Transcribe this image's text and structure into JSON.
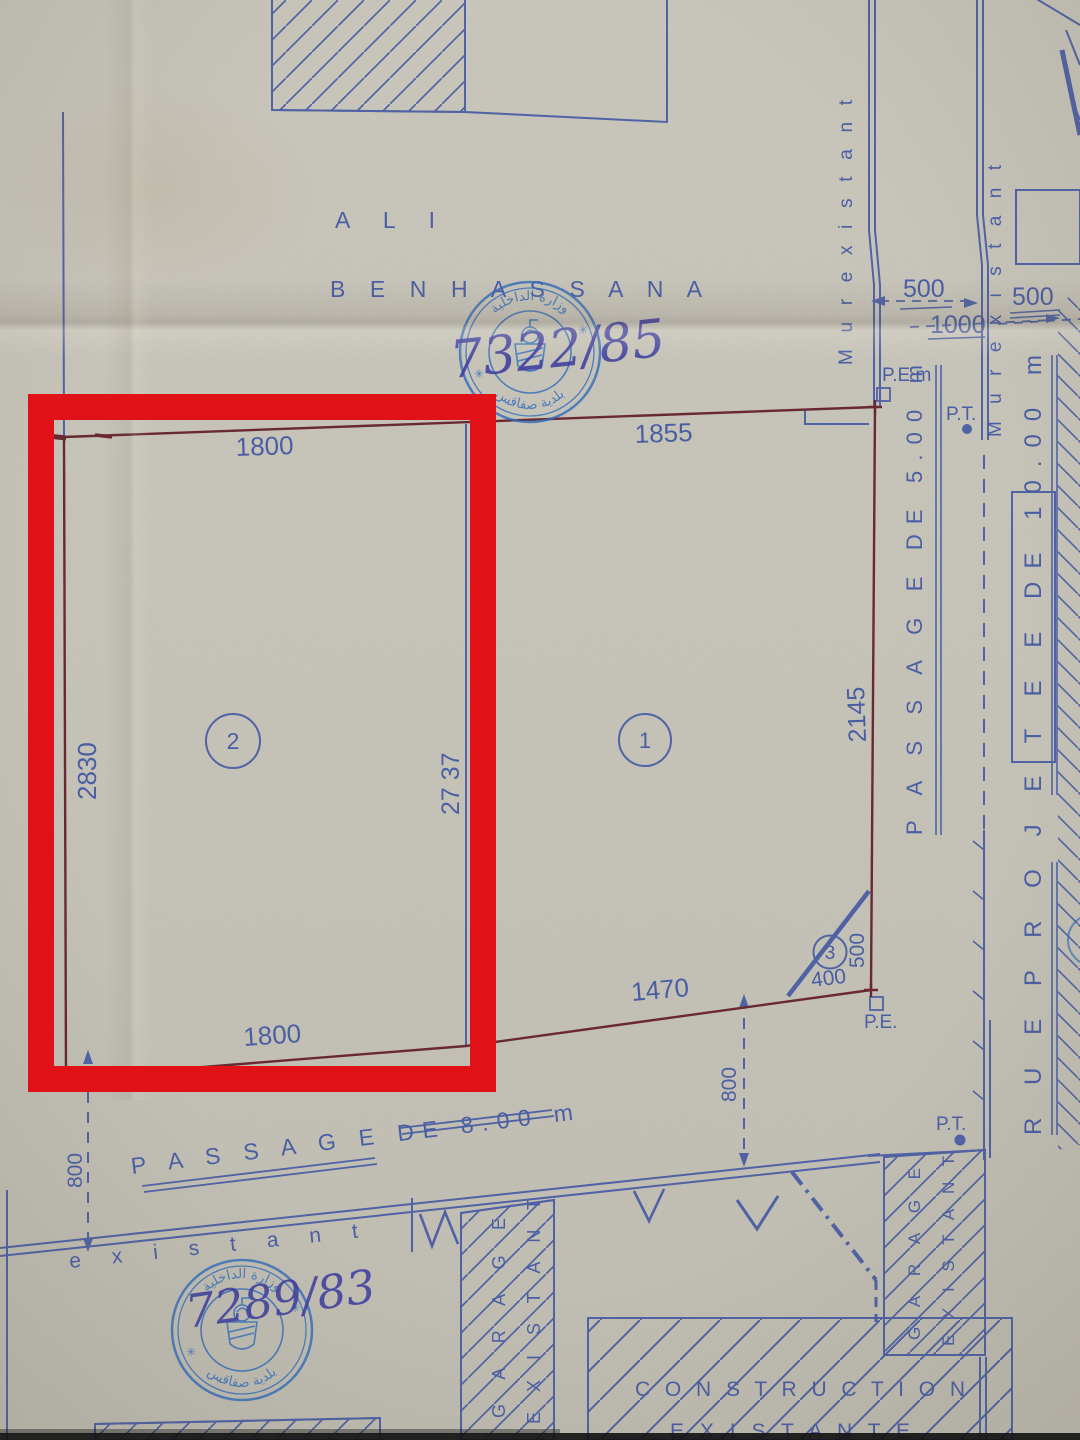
{
  "owner": {
    "line1": "A L I",
    "line2": "B E N   H A S S A N A"
  },
  "stamps": {
    "ministry_arabic": "وزارة الداخلية",
    "municipality_arabic": "بلدية صفاقس",
    "top_ref": "7322/85",
    "bottom_ref": "7289/83"
  },
  "parcels": {
    "p2": {
      "number": "2",
      "top": "1800",
      "bottom": "1800",
      "left": "2830",
      "divider": "27 37"
    },
    "p1": {
      "number": "1",
      "top": "1855",
      "bottom": "1470",
      "right": "2145"
    },
    "p3": {
      "number": "3",
      "bottom": "400",
      "side": "500"
    }
  },
  "dims": {
    "d500_a": "500",
    "d1000": "1000",
    "d500_b": "500",
    "d800_left": "800",
    "d800_right": "800"
  },
  "labels": {
    "mur_existant": "M u r   e x i s t a n t",
    "passage_east": "P A S S A G E   DE   5.00 m",
    "passage_south": "P A S S A G E    DE   8.00 m",
    "rue": "R U E   P R O J E T E E   DE   10.00 m",
    "existant": "e x i s t a n t",
    "garage_line1": "G A R A G E",
    "garage_line2": "E X I S T A N T",
    "construction_line1": "C O N S T R U C T I O N",
    "construction_line2": "E X I S T A N T E",
    "pe_m": "P.E.m",
    "pe": "P.E.",
    "pt": "P.T."
  },
  "icons": {
    "stamp_star": "✳"
  },
  "colors": {
    "paper": "#c7c4ba",
    "ink_blue": "#4a5ea4",
    "boundary_red": "#692832",
    "highlight_red": "#e01117",
    "stamp_blue": "#2f6cbb",
    "handwriting_ink": "#3f3f9f"
  }
}
